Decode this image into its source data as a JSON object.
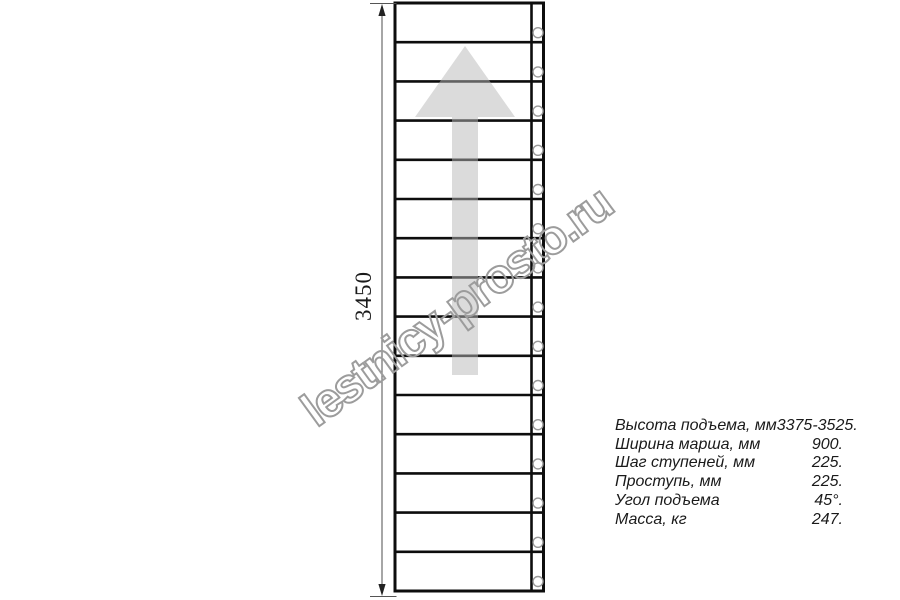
{
  "watermark": {
    "text": "lestnicy-prosto.ru",
    "outline_color": "#9c9c9c"
  },
  "drawing": {
    "dimension_label": "3450",
    "step_count": 15,
    "fastener_count": 15,
    "line_color": "#0d0d0d",
    "arrow_color": "rgba(184,184,184,0.5)",
    "fastener_stroke_color": "#999999",
    "dimension_line_color": "#777777"
  },
  "specs": {
    "rows": [
      {
        "label": "Высота подъема, мм",
        "value": "3375-3525."
      },
      {
        "label": "Ширина марша, мм",
        "value": "900."
      },
      {
        "label": "Шаг ступеней, мм",
        "value": "225."
      },
      {
        "label": "Проступь, мм",
        "value": "225."
      },
      {
        "label": "Угол подъема",
        "value": "45°."
      },
      {
        "label": "Масса, кг",
        "value": "247."
      }
    ]
  }
}
